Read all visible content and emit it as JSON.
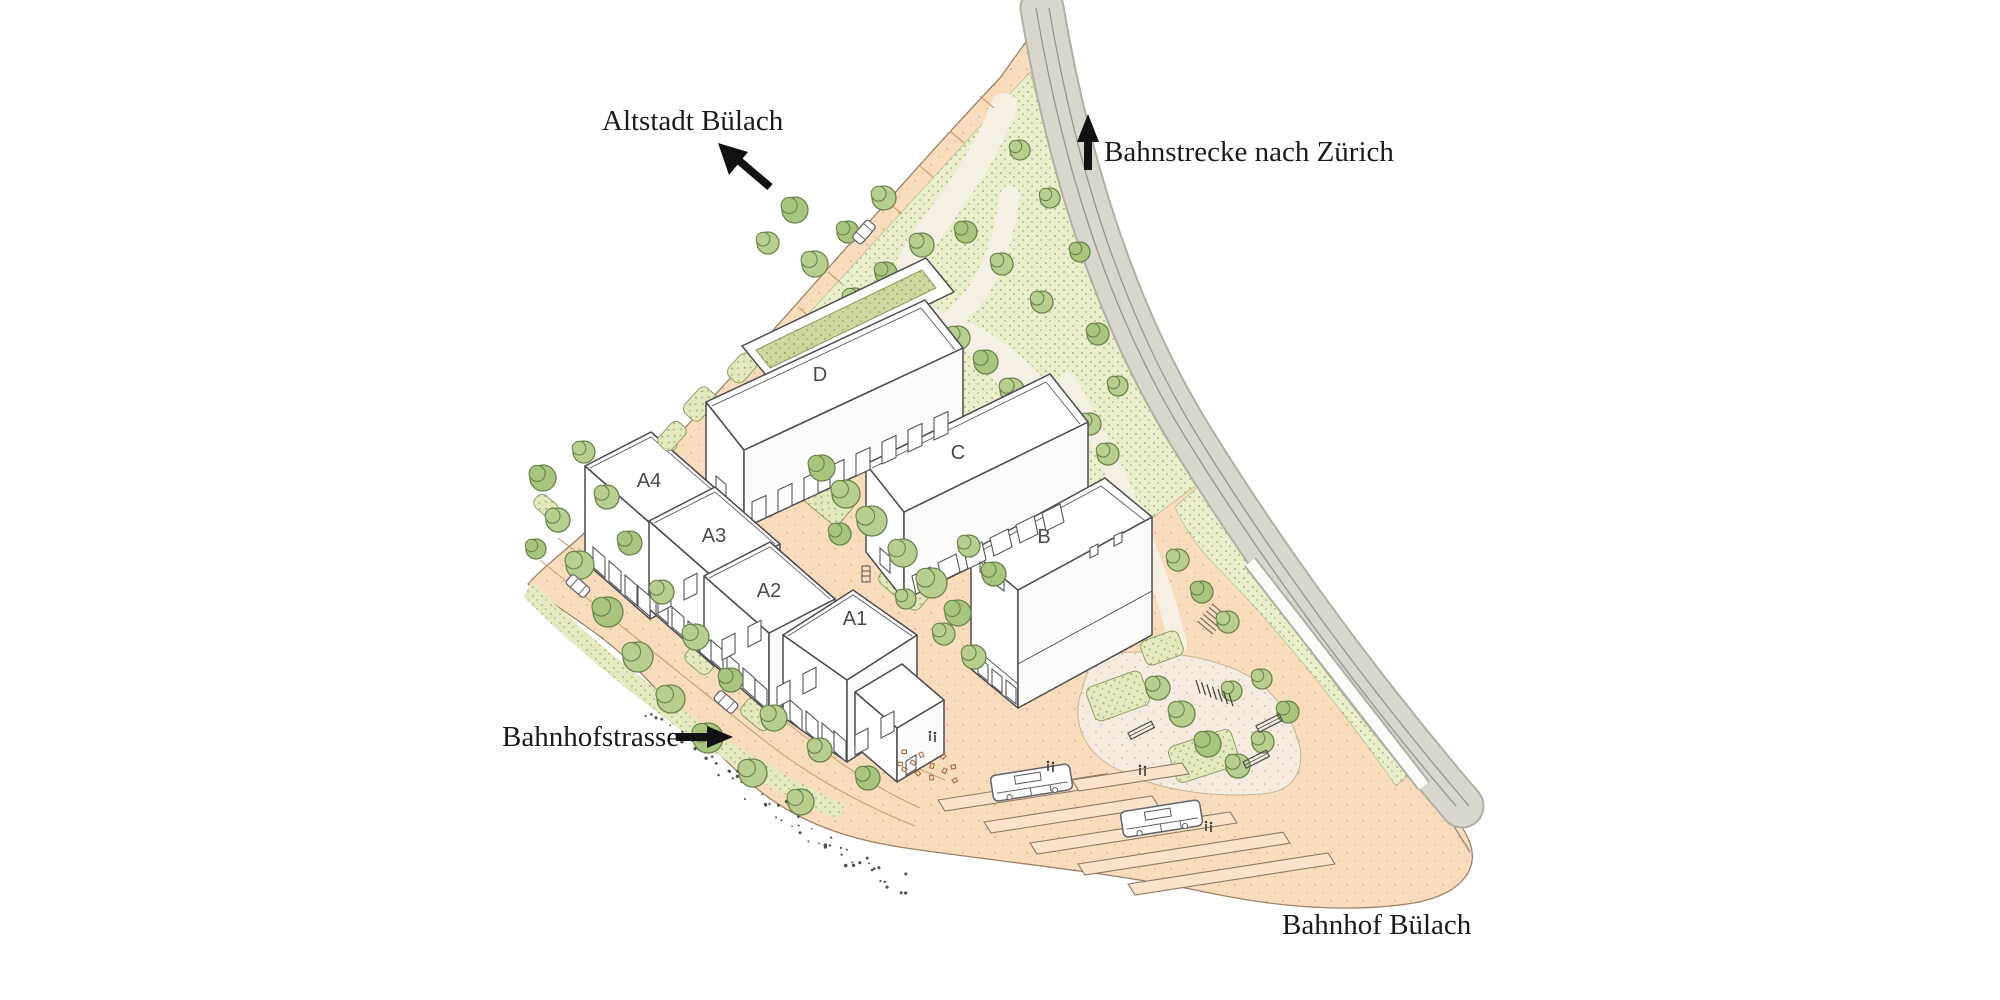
{
  "map_labels": {
    "altstadt": "Altstadt Bülach",
    "bahnstrecke": "Bahnstrecke nach Zürich",
    "bahnhofstrasse": "Bahnhofstrasse",
    "bahnhof": "Bahnhof Bülach"
  },
  "buildings": [
    {
      "label": "D"
    },
    {
      "label": "C"
    },
    {
      "label": "B"
    },
    {
      "label": "A4"
    },
    {
      "label": "A3"
    },
    {
      "label": "A2"
    },
    {
      "label": "A1"
    }
  ],
  "icons": {
    "altstadt_arrow": "arrow-up-left",
    "bahnstrecke_arrow": "arrow-up",
    "bahnhofstrasse_arrow": "arrow-right"
  },
  "colors": {
    "ground_peach": "#f8dcbc",
    "park_green_base": "#ebeecb",
    "stipple_green": "#72814a",
    "tree_green": "#b8ce8f",
    "tree_outline": "#69834b",
    "railway_gray": "#d8d5cc",
    "building_white": "#ffffff",
    "outline_ink": "#4c4c50",
    "label_ink": "#1b1b1b",
    "building_label_gray": "#4a4a4a"
  }
}
